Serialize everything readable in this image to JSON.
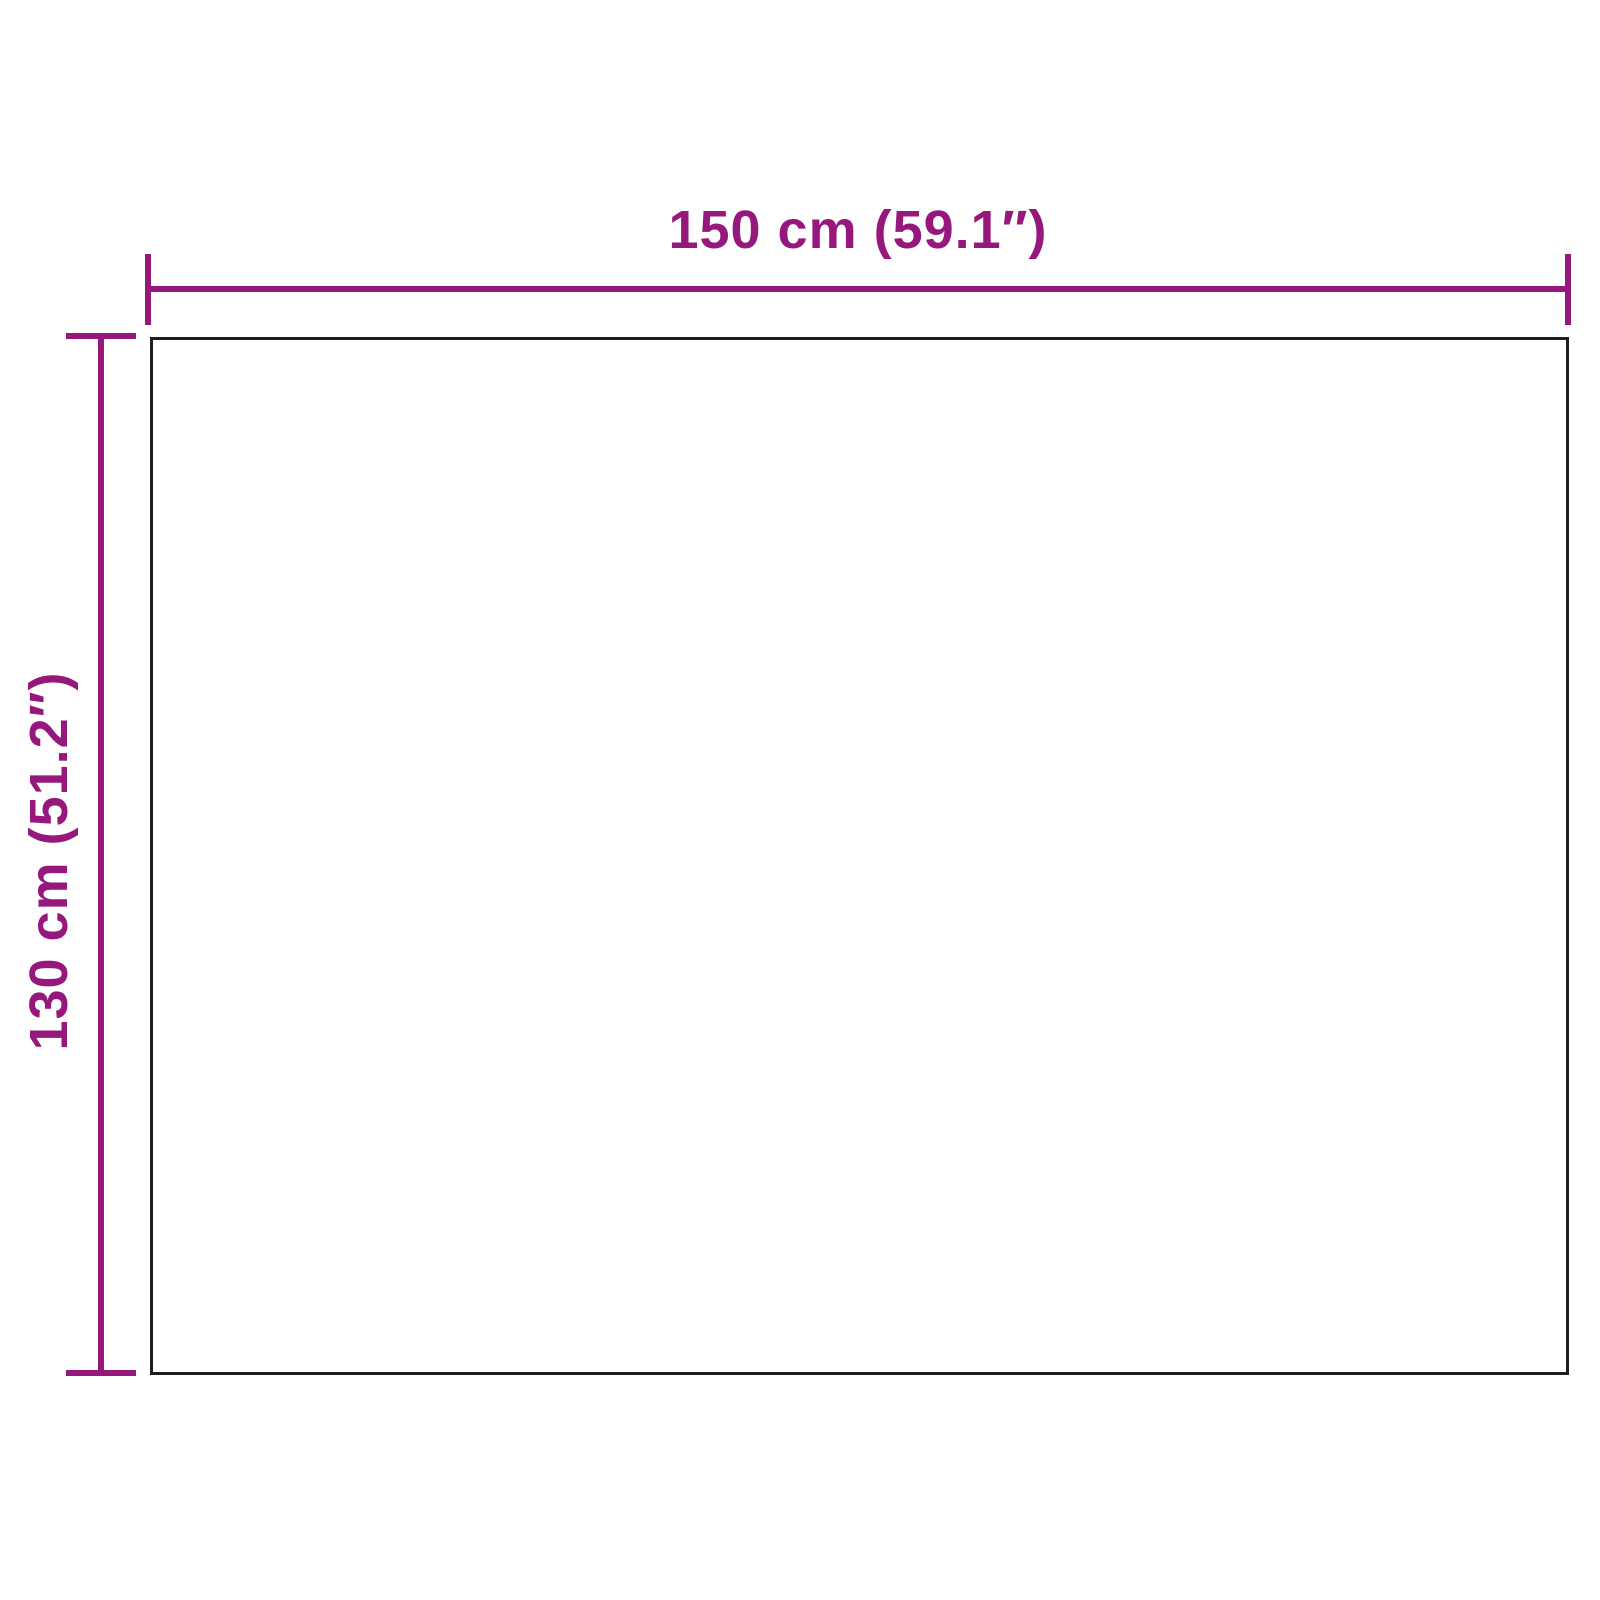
{
  "diagram": {
    "type": "product-dimensions",
    "width_dimension": {
      "label": "150 cm (59.1″)",
      "cm": 150,
      "inches": 59.1
    },
    "height_dimension": {
      "label": "130 cm (51.2″)",
      "cm": 130,
      "inches": 51.2
    },
    "colors": {
      "dimension": "#96187D",
      "outline": "#1E1E1E",
      "background": "#FFFFFF"
    }
  }
}
